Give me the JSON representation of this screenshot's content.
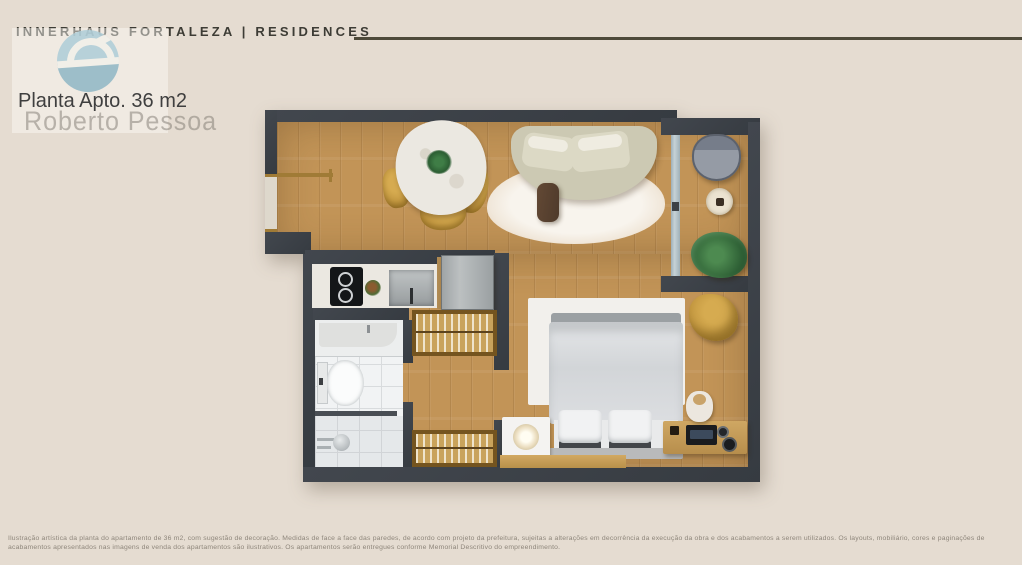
{
  "header": {
    "brand": "INNERHAUS FORTALEZA | RESIDENCES",
    "plan_title": "Planta Apto. 36 m2"
  },
  "watermark": {
    "name": "Roberto Pessoa",
    "logo_color": "#a7c9d4"
  },
  "floor_plan": {
    "apartment_area": "36 m2",
    "furniture_inventory": [
      "entry-door",
      "dining-table",
      "dining-chairs",
      "center-plant",
      "sofa",
      "coffee-table",
      "living-rug",
      "balcony-chair",
      "balcony-side-table",
      "balcony-plant",
      "sliding-glass-door",
      "cooktop",
      "kitchen-sink",
      "refrigerator",
      "clothes-rack-top",
      "clothes-rack-bottom",
      "bathroom-sink-counter",
      "toilet",
      "shower",
      "double-bed",
      "pillows",
      "bed-rug",
      "nightstand-lamp",
      "armchair",
      "media-console",
      "jar-lamp",
      "tv-device",
      "bench"
    ],
    "colors": {
      "wall": "#3e434a",
      "wood_floor": "#c29457",
      "tile": "#f1f3f4",
      "accent_mustard": "#c1953e",
      "background": "#e5dcd1"
    }
  },
  "disclaimer": "Ilustração artística da planta do apartamento de 36 m2, com sugestão de decoração. Medidas de face a face das paredes, de acordo com projeto da prefeitura, sujeitas a alterações em decorrência da execução da obra e dos acabamentos a serem utilizados. Os layouts, mobiliário, cores e paginações de acabamentos apresentados nas imagens de venda dos apartamentos são ilustrativos. Os apartamentos serão entregues conforme Memorial Descritivo do empreendimento."
}
